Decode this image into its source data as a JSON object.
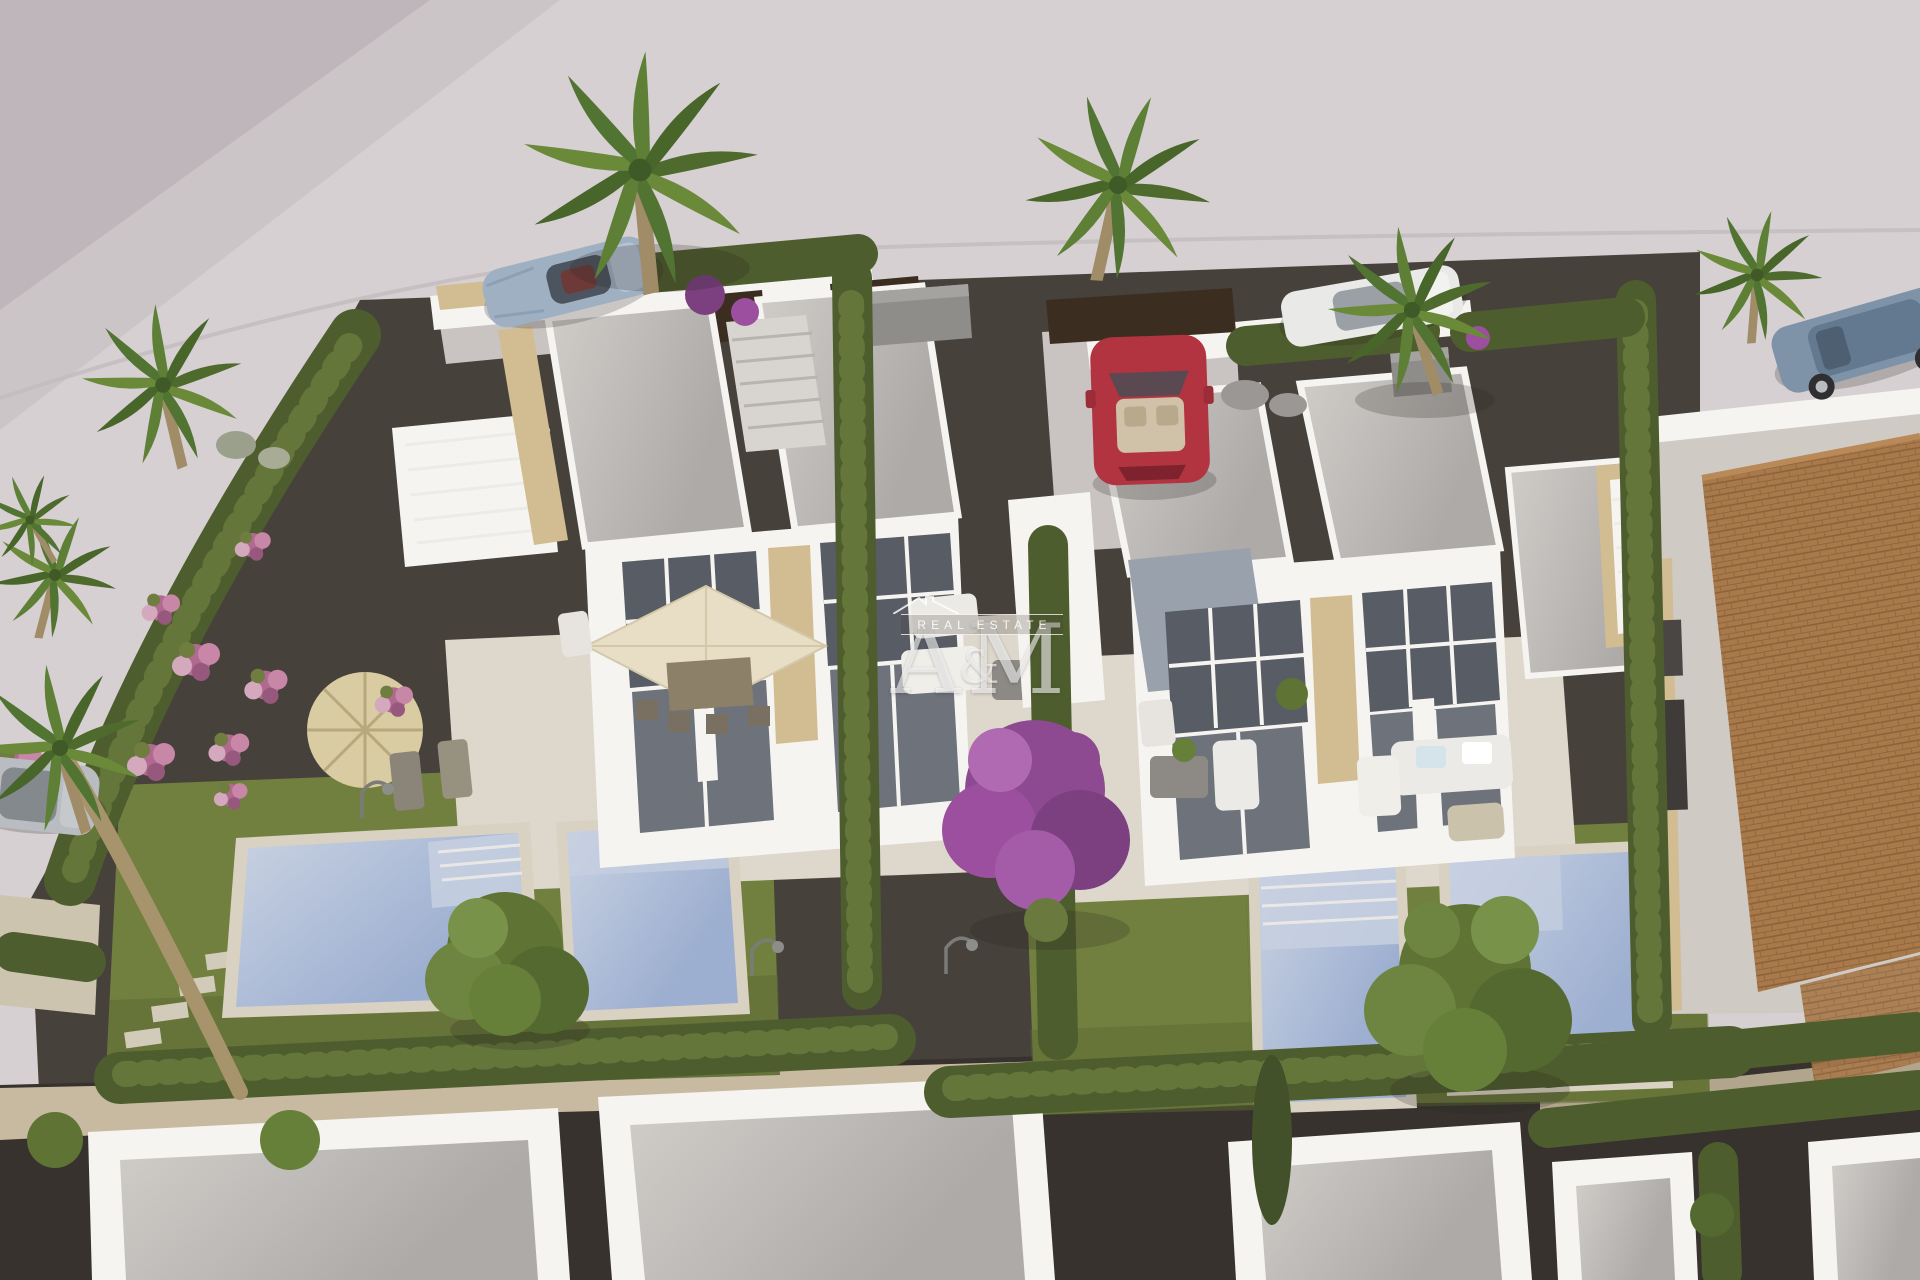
{
  "watermark": {
    "letter_a": "A",
    "ampersand": "&",
    "letter_m": "M",
    "tagline": "REAL ESTATE"
  },
  "palette": {
    "ground": "#d6d0d2",
    "ground_shadow": "#bab3b6",
    "road_sand": "#cfc2a6",
    "gravel_dark": "#47413c",
    "gravel_deep": "#37322e",
    "lawn": "#72803f",
    "lawn_shade": "#5c6a34",
    "hedge": "#4e5d2d",
    "hedge_light": "#6a7a3e",
    "pool_water": "#a7b7d3",
    "pool_light": "#c7d0e1",
    "pool_rim": "#d9d2c3",
    "wall_white": "#f6f4f1",
    "wall_shade": "#e3dfda",
    "roof_gray": "#c7c4c0",
    "roof_dark": "#aaa8a6",
    "stone_beige": "#d2bc92",
    "window_dark": "#585c64",
    "window_mid": "#6d727b",
    "terrace": "#ddd7cc",
    "terracotta": "#a87a4b",
    "tile_line": "#8a5f38",
    "fence_brown": "#3b2e21",
    "car_red": "#b23440",
    "car_silver": "#9fb0c3",
    "car_white": "#e9e9e7",
    "car_suv": "#7e93a8",
    "car_gray": "#b9bdc1",
    "palm_green": "#527433",
    "palm_trunk": "#a08c66",
    "flower_pink": "#c084a2",
    "flower_purple": "#9b4f9e",
    "rock_gray": "#9a9794",
    "gravel_blue": "#99a2ac",
    "parasol_straw": "#d9cba2",
    "parasol_cream": "#e8dec6",
    "furniture_white": "#eceae6",
    "watermark_white": "#ffffff"
  }
}
